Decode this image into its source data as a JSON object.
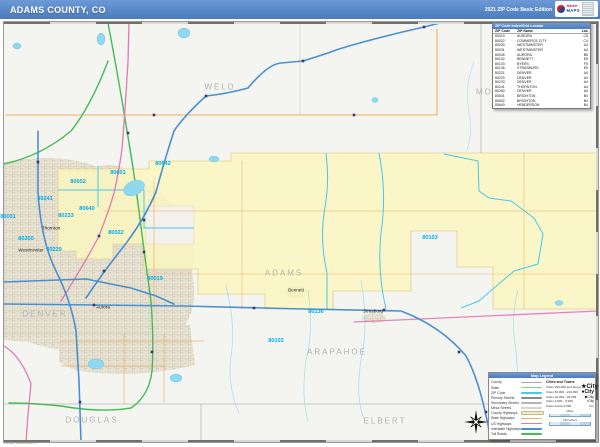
{
  "colors": {
    "header_blue": "#4a7cbd",
    "county_yellow": "#faf6c0",
    "zip_label_blue": "#00aeef",
    "county_label_gray": "#b4b4b2",
    "water_blue": "#8fd8f0",
    "interstate_blue": "#4a90d0",
    "toll_green": "#44bb55",
    "us_highway_pink": "#e07ab0",
    "county_road_orange": "#f0b060"
  },
  "header": {
    "title": "ADAMS COUNTY, CO",
    "edition": "2021 ZIP Code Basic Edition",
    "logo": {
      "word_top": "Market",
      "word_bottom": "MAPS"
    }
  },
  "zip_table": {
    "title": "ZIP Code Index/Grid Locator",
    "columns": [
      "ZIP Code",
      "ZIP Name",
      "Loc"
    ],
    "rows": [
      [
        "80019",
        "AURORA",
        "C5"
      ],
      [
        "80022",
        "COMMERCE CITY",
        "C4"
      ],
      [
        "80030",
        "WESTMINSTER",
        "A4"
      ],
      [
        "80031",
        "WESTMINSTER",
        "A4"
      ],
      [
        "80045",
        "AURORA",
        "B5"
      ],
      [
        "80102",
        "BENNETT",
        "E5"
      ],
      [
        "80103",
        "BYERS",
        "F5"
      ],
      [
        "80136",
        "STRASBURG",
        "E5"
      ],
      [
        "80221",
        "DENVER",
        "A4"
      ],
      [
        "80229",
        "DENVER",
        "A4"
      ],
      [
        "80233",
        "DENVER",
        "A4"
      ],
      [
        "80241",
        "THORNTON",
        "A4"
      ],
      [
        "80260",
        "DENVER",
        "A4"
      ],
      [
        "80601",
        "BRIGHTON",
        "B4"
      ],
      [
        "80602",
        "BRIGHTON",
        "B4"
      ],
      [
        "80640",
        "HENDERSON",
        "B4"
      ]
    ]
  },
  "map": {
    "county_labels": [
      {
        "text": "WELD",
        "x": 217,
        "y": 66
      },
      {
        "text": "MORGAN",
        "x": 497,
        "y": 71
      },
      {
        "text": "ADAMS",
        "x": 281,
        "y": 252
      },
      {
        "text": "DENVER",
        "x": 42,
        "y": 293
      },
      {
        "text": "ARAPAHOE",
        "x": 334,
        "y": 331
      },
      {
        "text": "DOUGLAS",
        "x": 89,
        "y": 399
      },
      {
        "text": "ELBERT",
        "x": 382,
        "y": 400
      }
    ],
    "city_labels": [
      {
        "text": "Westminster",
        "x": 28,
        "y": 229
      },
      {
        "text": "Thornton",
        "x": 48,
        "y": 207
      },
      {
        "text": "Aurora",
        "x": 100,
        "y": 286
      },
      {
        "text": "Bennett",
        "x": 293,
        "y": 269
      },
      {
        "text": "Strasburg",
        "x": 370,
        "y": 290
      }
    ],
    "zip_labels": [
      {
        "text": "80602",
        "x": 75,
        "y": 161
      },
      {
        "text": "80601",
        "x": 115,
        "y": 152
      },
      {
        "text": "80642",
        "x": 160,
        "y": 143
      },
      {
        "text": "80241",
        "x": 42,
        "y": 178
      },
      {
        "text": "80233",
        "x": 63,
        "y": 195
      },
      {
        "text": "80260",
        "x": 23,
        "y": 218
      },
      {
        "text": "80229",
        "x": 51,
        "y": 229
      },
      {
        "text": "80640",
        "x": 84,
        "y": 188
      },
      {
        "text": "80022",
        "x": 113,
        "y": 212
      },
      {
        "text": "80031",
        "x": 5,
        "y": 196
      },
      {
        "text": "80019",
        "x": 152,
        "y": 258
      },
      {
        "text": "80103",
        "x": 427,
        "y": 217
      },
      {
        "text": "80136",
        "x": 313,
        "y": 291
      },
      {
        "text": "80102",
        "x": 273,
        "y": 320
      }
    ],
    "copyright": "©2021 MarketMAPS"
  },
  "legend": {
    "title": "Map Legend",
    "line_items": [
      {
        "label": "County",
        "color": "#aaaaaa"
      },
      {
        "label": "State",
        "color": "#7bd87b"
      },
      {
        "label": "ZIP Code",
        "color": "#45c8f0"
      },
      {
        "label": "Primary Streets",
        "color": "#8a8a8a"
      },
      {
        "label": "Secondary Streets",
        "color": "#b5b5b5"
      },
      {
        "label": "Minor Streets",
        "color": "#d5d5d5"
      },
      {
        "label": "County Highways",
        "color": "#f2e9c8"
      },
      {
        "label": "State Highways",
        "color": "#f0b060"
      },
      {
        "label": "US Highways",
        "color": "#e07ab0"
      },
      {
        "label": "Interstate Highways",
        "color": "#4a90d0"
      },
      {
        "label": "Toll Roads",
        "color": "#44bb55"
      }
    ],
    "cities_header": "Cities and Towns",
    "city_items": [
      {
        "range": "Cities 250,000 and above",
        "marker": "★",
        "sample": "City",
        "size": "xl"
      },
      {
        "range": "Cities 50,000 - 249,999",
        "marker": "●",
        "sample": "City",
        "size": "lg"
      },
      {
        "range": "Cities 10,000 - 49,999",
        "marker": "■",
        "sample": "City",
        "size": "md"
      },
      {
        "range": "Cities 2,500 - 9,999",
        "marker": "•",
        "sample": "City",
        "size": "sm"
      },
      {
        "range": "Cities below 2,500",
        "marker": "·",
        "sample": "City",
        "size": "xs"
      }
    ],
    "scales": [
      "Miles",
      "Kilometers"
    ]
  }
}
